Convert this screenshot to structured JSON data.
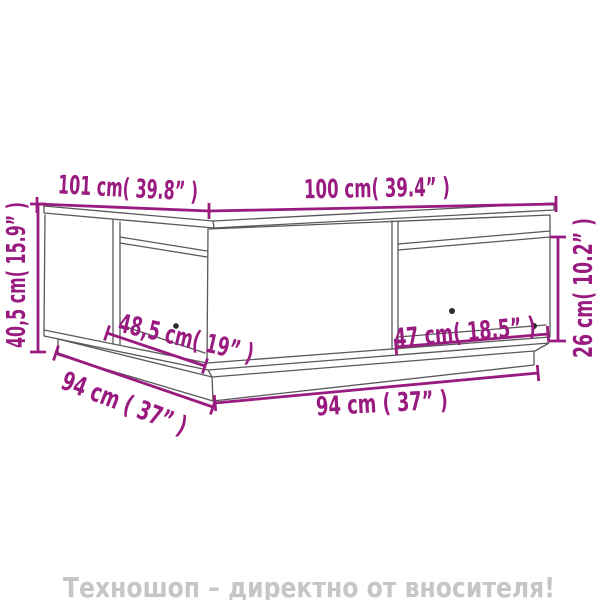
{
  "colors": {
    "background": "#ffffff",
    "line": "#59595b",
    "dimension": "#9a1b80",
    "dot": "#2b2b2b",
    "banner": "#c6c6c6"
  },
  "diagram": {
    "type": "furniture-dimension-drawing",
    "dimensions": {
      "depth_top": "101 cm( 39.8” )",
      "width_top": "100 cm( 39.4” )",
      "height_left": "40,5 cm( 15.9” )",
      "compartment_height_right": "26 cm( 10.2” )",
      "compartment_width_left": "48,5 cm( 19” )",
      "compartment_width_right": "47 cm( 18.5” )",
      "base_depth_left": "94 cm ( 37” )",
      "base_width_bottom": "94 cm ( 37” )"
    }
  },
  "footer": {
    "banner_text": "Техношоп – директно от вносителя!"
  }
}
